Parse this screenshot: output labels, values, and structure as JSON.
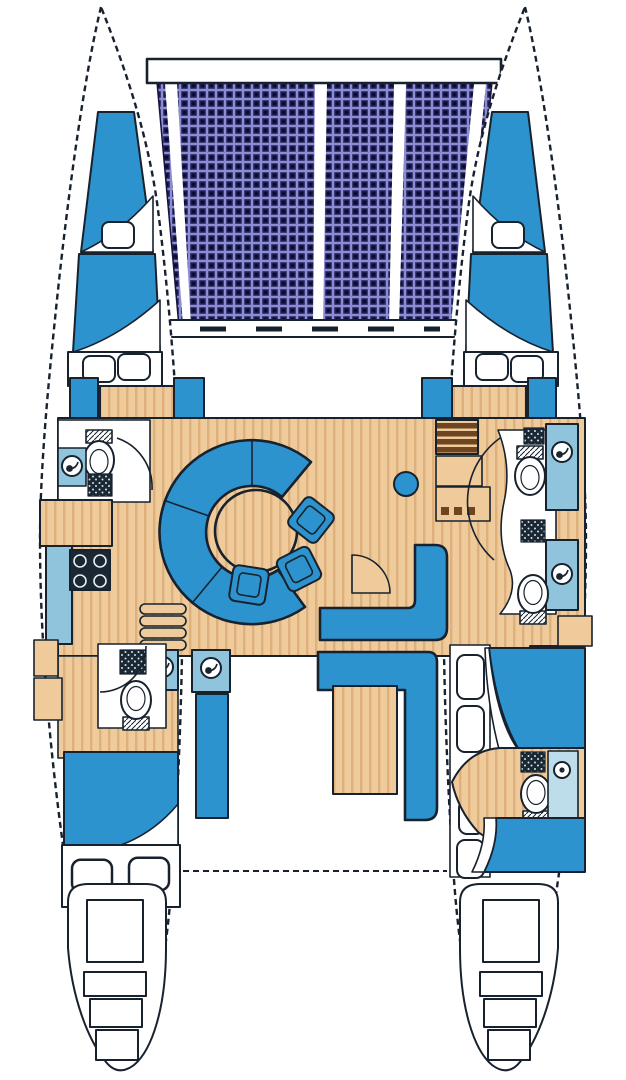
{
  "title": "Catamaran sailing yacht — interior layout floor plan (top view)",
  "canvas": {
    "width": 626,
    "height": 1080
  },
  "palette": {
    "outline": "#17222e",
    "berth_blue": "#2D93CE",
    "counter_blue": "#8FC4DC",
    "shower_blue": "#BDDDEB",
    "wood": "#EFCB9C",
    "wood_grain": "#DEB07C",
    "steps_brown": "#6E4520",
    "appliance_dark": "#1B2733",
    "net_navy": "#26265E",
    "net_grid": "#8C8CD4",
    "net_dark": "#0C0C30",
    "deck_white": "#FFFFFF"
  },
  "vessel": {
    "type": "catamaran floor plan",
    "areas": {
      "trampoline": "bow trampoline net with lacing strips",
      "forward_crossbeam": "forward crossbeam",
      "mast_beam": "main beam at mast",
      "port_hull": "port hull (left)",
      "starboard_hull": "starboard hull (right)",
      "port_forward_cabin": "port forward double berth with pillows",
      "starboard_forward_cabin": "starboard forward double berth with pillows",
      "port_forward_head": "port forward head with toilet, sink and shower",
      "galley": "port galley with stove and counters",
      "salon": "central salon with curved settee, round table and chairs",
      "nav_area": "starboard companionway steps and cabinets",
      "port_aft_head": "port aft head with toilet, sink and shower",
      "port_aft_cabin": "port aft double berth with pillows",
      "starboard_heads": "starboard twin heads with toilets and sinks",
      "starboard_aft_cabin": "starboard aft berth with pillows and en-suite",
      "cockpit": "aft cockpit with L-bench and table",
      "stern_platforms": "twin stern platforms with boarding steps"
    }
  }
}
